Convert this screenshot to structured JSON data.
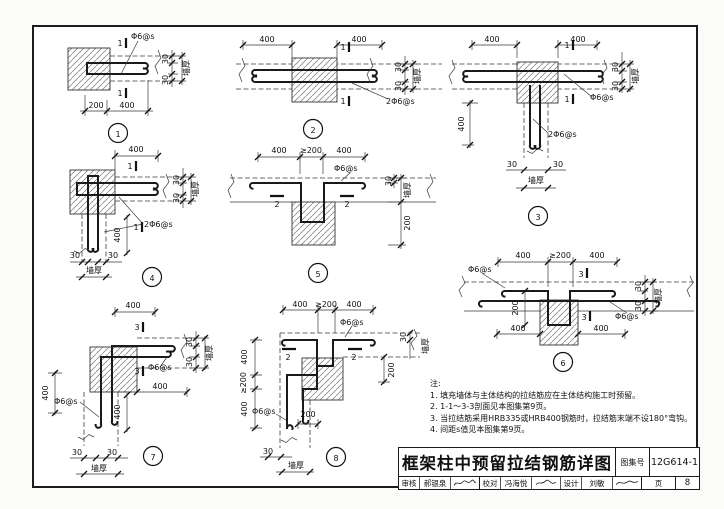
{
  "labels": {
    "tie_bar": "Φ6@s",
    "tie_bar_double": "2Φ6@s",
    "wall_thickness": "墙厚",
    "dim_400": "400",
    "dim_200": "200",
    "dim_ge_200": "≥200",
    "dim_30": "30",
    "section_1": "1",
    "section_2": "2",
    "section_3": "3"
  },
  "figures": [
    {
      "num": "1"
    },
    {
      "num": "2"
    },
    {
      "num": "3"
    },
    {
      "num": "4"
    },
    {
      "num": "5"
    },
    {
      "num": "6"
    },
    {
      "num": "7"
    },
    {
      "num": "8"
    }
  ],
  "notes": {
    "heading": "注:",
    "items": [
      "1.  填充墙体与主体结构的拉结筋应在主体结构施工时预留。",
      "2.  1-1～3-3剖面见本图集第9页。",
      "3.  当拉结筋采用HRB335或HRB400钢筋时，拉结筋末端不设180°弯钩。",
      "4.  间距s值见本图集第9页。"
    ]
  },
  "titleblock": {
    "title": "框架柱中预留拉结钢筋详图",
    "atlas_label": "图集号",
    "atlas_no": "12G614-1",
    "page_label": "页",
    "page_no": "8",
    "review_label": "审核",
    "reviewer": "郝银泉",
    "check_label": "校对",
    "checker": "冯海悦",
    "design_label": "设计",
    "designer": "刘敏"
  }
}
